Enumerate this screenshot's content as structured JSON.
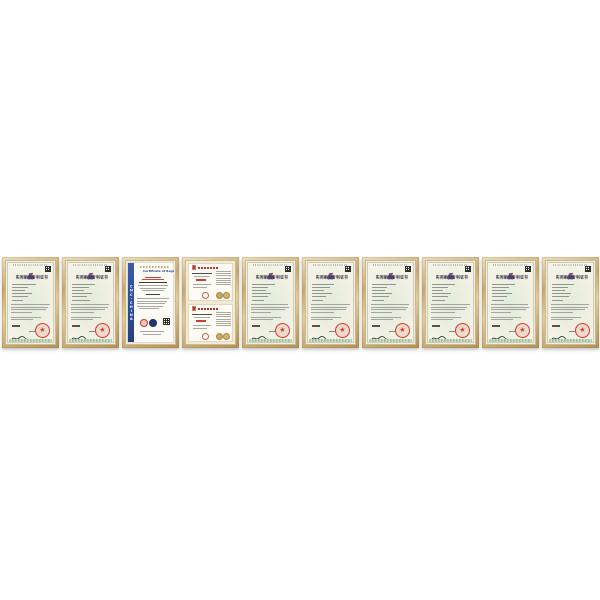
{
  "page": {
    "background_color": "#ffffff"
  },
  "gallery": {
    "description": "row of ten framed company qualification certificates on white background",
    "layout": {
      "top": 257,
      "left": 2,
      "frame_width": 57,
      "frame_height": 91,
      "gap": 3
    },
    "colors": {
      "frame_gold": "#c9aa70",
      "mat_cream": "#f2edda",
      "patent_paper": "#f5f3e7",
      "patent_green_tint": "#e2ebda",
      "seal_red": "#d23b28",
      "emblem_purple": "#6a55a0",
      "emblem_accent_red": "#c0392b",
      "iso_band_blue": "#2e4d96",
      "iso_title_navy": "#1f3a7a",
      "iso_badge_navy": "#24356f",
      "honor_red": "#b5342c",
      "gold_badge": "#c9a85c",
      "text_dark": "#2f2f33",
      "line_gray": "#8e958f",
      "green_band": "#9cbf97"
    },
    "certificates": [
      {
        "type": "patent",
        "title": "实用新型专利证书",
        "info_line_widths": [
          62,
          40,
          34,
          50,
          42,
          28
        ],
        "para_line_widths": [
          100,
          96,
          90,
          55
        ]
      },
      {
        "type": "patent",
        "title": "实用新型专利证书",
        "info_line_widths": [
          58,
          44,
          30,
          52,
          38,
          46
        ],
        "para_line_widths": [
          98,
          94,
          88,
          60
        ]
      },
      {
        "type": "iso",
        "title": "Certificate of Registration",
        "side_band_text": "CNC-CHINA"
      },
      {
        "type": "honor_double",
        "halves": 2
      },
      {
        "type": "patent",
        "title": "实用新型专利证书",
        "info_line_widths": [
          60,
          42,
          36,
          48,
          40,
          30
        ],
        "para_line_widths": [
          96,
          98,
          86,
          52
        ]
      },
      {
        "type": "patent",
        "title": "实用新型专利证书",
        "info_line_widths": [
          56,
          46,
          32,
          50,
          36,
          28
        ],
        "para_line_widths": [
          100,
          92,
          90,
          58
        ]
      },
      {
        "type": "patent",
        "title": "实用新型专利证书",
        "info_line_widths": [
          62,
          38,
          34,
          52,
          44,
          30
        ],
        "para_line_widths": [
          97,
          95,
          89,
          55
        ]
      },
      {
        "type": "patent",
        "title": "实用新型专利证书",
        "info_line_widths": [
          58,
          42,
          28,
          48,
          40,
          34
        ],
        "para_line_widths": [
          99,
          93,
          87,
          62
        ]
      },
      {
        "type": "patent",
        "title": "实用新型专利证书",
        "info_line_widths": [
          60,
          44,
          36,
          50,
          38,
          30
        ],
        "para_line_widths": [
          96,
          97,
          91,
          50
        ]
      },
      {
        "type": "patent",
        "title": "实用新型专利证书",
        "info_line_widths": [
          57,
          41,
          33,
          49,
          43,
          29
        ],
        "para_line_widths": [
          98,
          95,
          88,
          57
        ]
      }
    ]
  }
}
